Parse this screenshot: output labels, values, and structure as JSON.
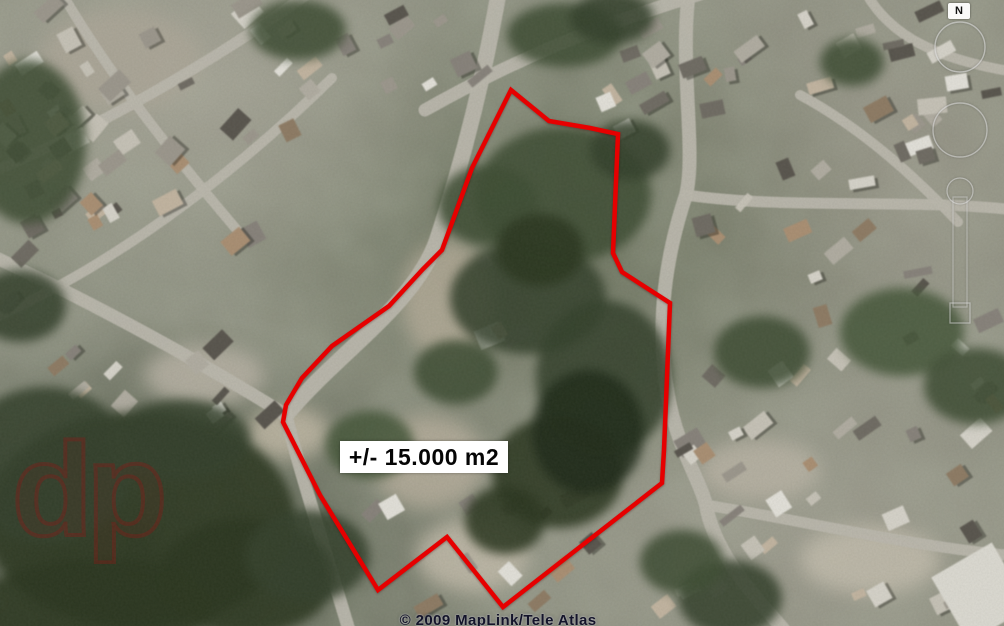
{
  "map": {
    "area_label": "+/- 15.000 m2",
    "polygon_color": "#e60000",
    "polygon_stroke_width": 4.5,
    "polygon_points": [
      [
        511,
        90
      ],
      [
        549,
        121
      ],
      [
        590,
        128
      ],
      [
        618,
        134
      ],
      [
        613,
        253
      ],
      [
        622,
        272
      ],
      [
        670,
        303
      ],
      [
        664,
        450
      ],
      [
        662,
        483
      ],
      [
        503,
        607
      ],
      [
        447,
        537
      ],
      [
        378,
        590
      ],
      [
        320,
        495
      ],
      [
        283,
        422
      ],
      [
        286,
        405
      ],
      [
        302,
        378
      ],
      [
        332,
        346
      ],
      [
        389,
        306
      ],
      [
        423,
        269
      ],
      [
        442,
        250
      ],
      [
        472,
        168
      ]
    ],
    "label_box": {
      "x": 340,
      "y": 441,
      "width": 168,
      "height": 32
    },
    "label_background": "#ffffff",
    "label_text_color": "#050505"
  },
  "compass": {
    "north_label": "N"
  },
  "attribution": {
    "copyright": "© 2009 MapLink/Tele Atlas"
  },
  "watermark": {
    "logo_text": "dp"
  }
}
